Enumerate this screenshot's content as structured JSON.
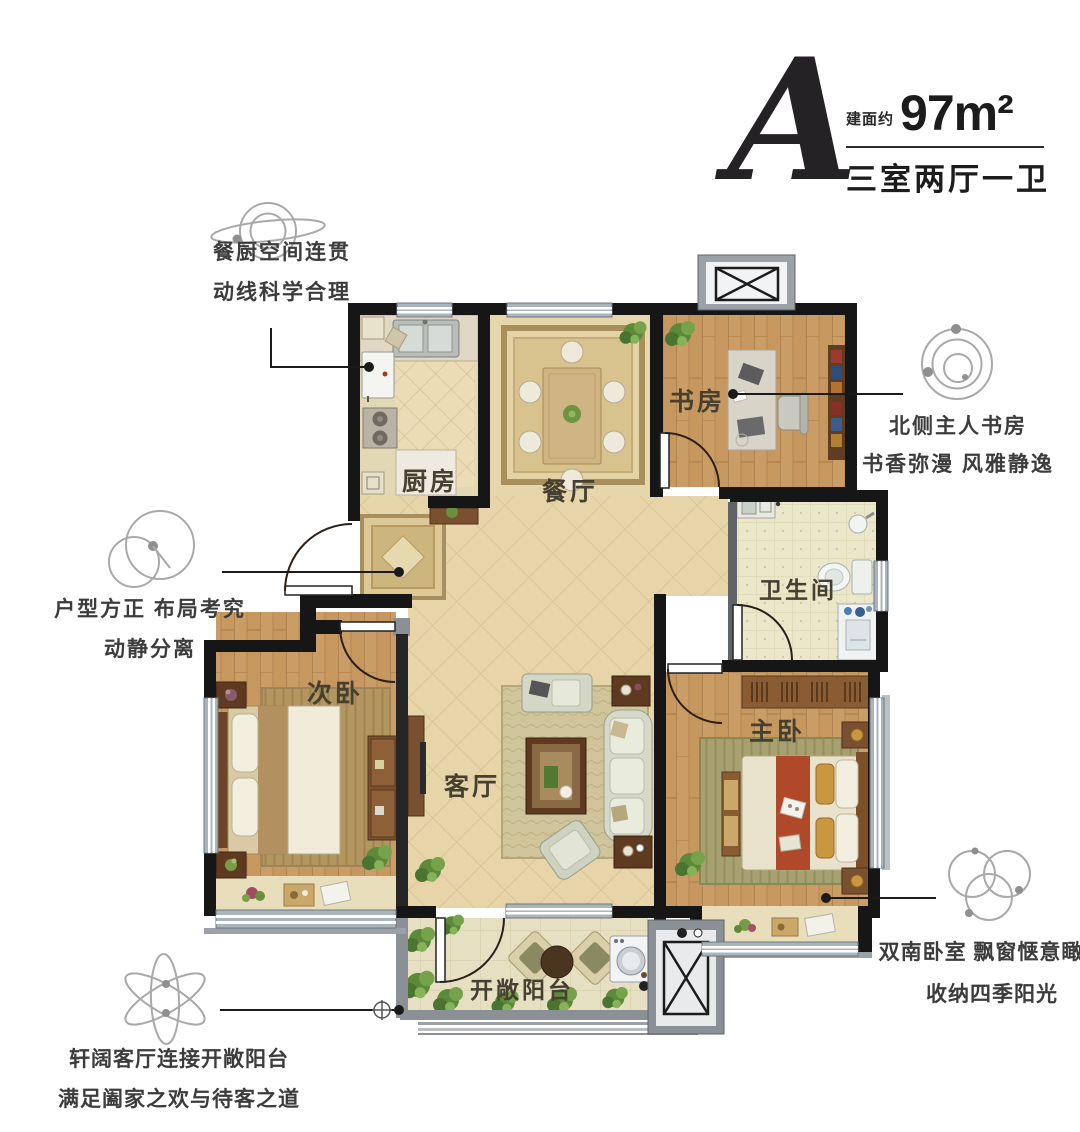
{
  "title": {
    "plan_letter": "A",
    "area_prefix": "建面约",
    "area_value": "97m²",
    "layout_type": "三室两厅一卫"
  },
  "callouts": {
    "kitchen_dining": {
      "line1": "餐厨空间连贯",
      "line2": "动线科学合理",
      "icon": "saturn-orbit-icon"
    },
    "layout": {
      "line1": "户型方正 布局考究",
      "line2": "动静分离",
      "icon": "overlapping-circles-icon"
    },
    "study": {
      "line1": "北侧主人书房",
      "line2": "书香弥漫 风雅静逸",
      "icon": "concentric-orbits-icon"
    },
    "master_bedroom": {
      "line1": "双南卧室 飘窗惬意瞰景",
      "line2": "收纳四季阳光",
      "icon": "triple-circles-icon"
    },
    "living_balcony": {
      "line1": "轩阔客厅连接开敞阳台",
      "line2": "满足阖家之欢与待客之道",
      "icon": "atom-icon"
    }
  },
  "rooms": {
    "kitchen": "厨房",
    "dining": "餐厅",
    "study": "书房",
    "bathroom": "卫生间",
    "secondary_bedroom": "次卧",
    "living_room": "客厅",
    "master_bedroom": "主卧",
    "balcony": "开敞阳台"
  },
  "colors": {
    "wall": "#161616",
    "interior_wall": "#5f6468",
    "window_band": "#aab4bc",
    "wood_floor": "#c6975f",
    "tile_floor": "#e7d5a9",
    "bath_floor": "#ebe7ca",
    "bed_runner_accent": "#b0492a",
    "plant_green": "#5d8a38",
    "callout_text": "#3c3c3c",
    "icon_gray": "#a9a9a9"
  }
}
